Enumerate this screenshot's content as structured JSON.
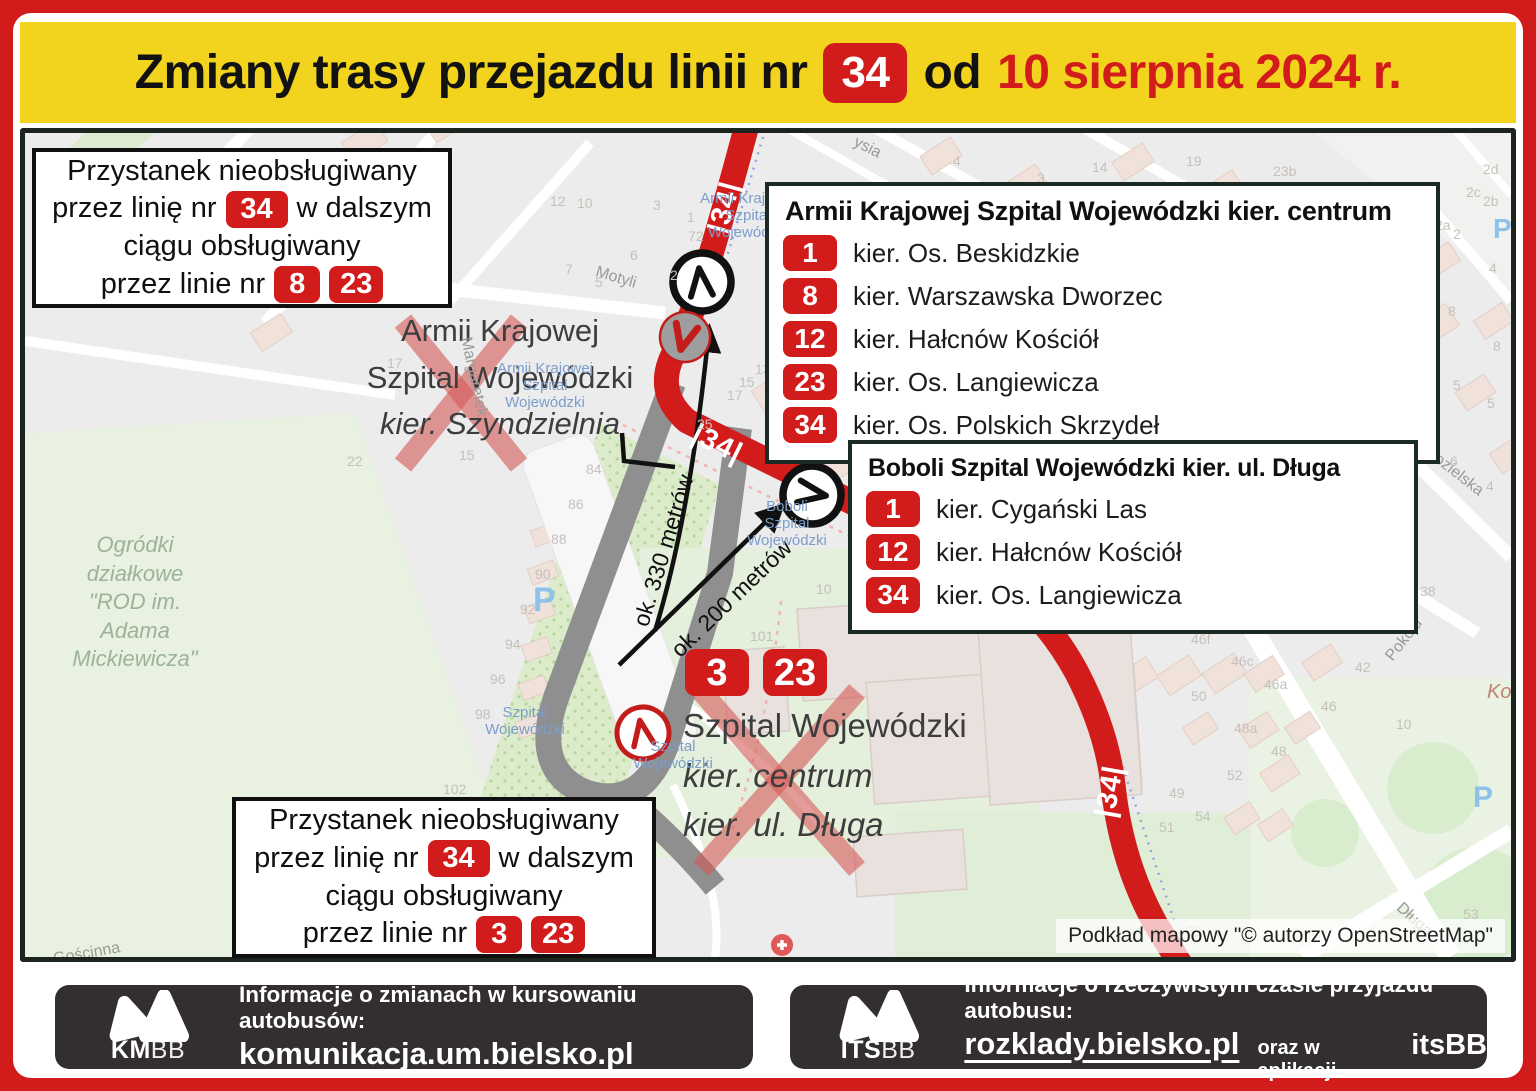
{
  "colors": {
    "accent_red": "#d21b1b",
    "header_yellow": "#f2d31d",
    "footer_dark": "#332e2f",
    "old_route_gray": "#8f8f8f"
  },
  "header": {
    "prefix": "Zmiany trasy przejazdu linii nr",
    "line_badge": "34",
    "mid": "od",
    "date": "10 sierpnia 2024 r."
  },
  "notices": {
    "top": {
      "l1": "Przystanek nieobsługiwany",
      "l2a": "przez linię nr",
      "l2badge": "34",
      "l2b": "w dalszym",
      "l3": "ciągu obsługiwany",
      "l4a": "przez linie nr",
      "badges": [
        "8",
        "23"
      ]
    },
    "bottom": {
      "l1": "Przystanek nieobsługiwany",
      "l2a": "przez linię nr",
      "l2badge": "34",
      "l2b": "w dalszym",
      "l3": "ciągu obsługiwany",
      "l4a": "przez linie nr",
      "badges": [
        "3",
        "23"
      ]
    }
  },
  "stop_boxes": {
    "armii": {
      "title": "Armii Krajowej Szpital Wojewódzki kier. centrum",
      "rows": [
        {
          "line": "1",
          "dest": "kier. Os. Beskidzkie"
        },
        {
          "line": "8",
          "dest": "kier. Warszawska Dworzec"
        },
        {
          "line": "12",
          "dest": "kier. Hałcnów Kościół"
        },
        {
          "line": "23",
          "dest": "kier. Os. Langiewicza"
        },
        {
          "line": "34",
          "dest": "kier. Os. Polskich Skrzydeł"
        }
      ]
    },
    "boboli": {
      "title": "Boboli Szpital Wojewódzki kier. ul. Długa",
      "rows": [
        {
          "line": "1",
          "dest": "kier. Cygański Las"
        },
        {
          "line": "12",
          "dest": "kier. Hałcnów Kościół"
        },
        {
          "line": "34",
          "dest": "kier. Os. Langiewicza"
        }
      ]
    }
  },
  "map": {
    "route_badge": "|34|",
    "attribution": "Podkład mapowy \"© autorzy OpenStreetMap\"",
    "dist330": "ok. 330 metrów",
    "dist200": "ok. 200 metrów",
    "armii_x": {
      "l1": "Armii Krajowej",
      "l2": "Szpital Wojewódzki",
      "l3": "kier. Szyndzielnia"
    },
    "terminal_x": {
      "badges": [
        "3",
        "23"
      ],
      "l1": "Szpital Wojewódzki",
      "l2": "kier. centrum",
      "l3": "kier. ul. Długa"
    },
    "garden_lines": [
      "Ogródki",
      "działkowe",
      "\"ROD im.",
      "Adama",
      "Mickiewicza\""
    ],
    "osm_stops": [
      {
        "x": 723,
        "y": 58,
        "lines": [
          "Armii Krajowej",
          "Szpital",
          "Wojewódzki"
        ]
      },
      {
        "x": 520,
        "y": 228,
        "lines": [
          "Armii Krajowej",
          "Szpital",
          "Wojewódzki"
        ]
      },
      {
        "x": 500,
        "y": 572,
        "lines": [
          "Szpital",
          "Wojewódzki"
        ]
      },
      {
        "x": 648,
        "y": 606,
        "lines": [
          "Szpital",
          "Wojewódzki"
        ]
      },
      {
        "x": 762,
        "y": 366,
        "lines": [
          "Boboli",
          "Szpital",
          "Wojewódzki"
        ]
      }
    ],
    "parking": [
      {
        "x": 508,
        "y": 448,
        "s": 34
      },
      {
        "x": 1448,
        "y": 648,
        "s": 30
      },
      {
        "x": 1468,
        "y": 80,
        "s": 28
      }
    ],
    "streets": [
      {
        "t": "Motyli",
        "x": 570,
        "y": 136,
        "r": 17
      },
      {
        "t": "ysia",
        "x": 828,
        "y": 6,
        "r": 27
      },
      {
        "t": "Margaretek",
        "x": 408,
        "y": 235,
        "r": 78
      },
      {
        "t": "Lniana",
        "x": 1300,
        "y": 450,
        "r": 33
      },
      {
        "t": "Pokoju",
        "x": 1355,
        "y": 498,
        "r": -52
      },
      {
        "t": "Kozielska",
        "x": 1395,
        "y": 330,
        "r": 38
      },
      {
        "t": "Długa",
        "x": 1368,
        "y": 778,
        "r": 42
      },
      {
        "t": "Gościnna",
        "x": 28,
        "y": 812,
        "r": -10
      },
      {
        "t": "Kom",
        "x": 1462,
        "y": 548,
        "r": 0,
        "c": "#c0826d",
        "s": 20,
        "i": true
      }
    ],
    "house_numbers": [
      {
        "t": "12",
        "x": 525,
        "y": 60
      },
      {
        "t": "10",
        "x": 552,
        "y": 62
      },
      {
        "t": "3",
        "x": 628,
        "y": 64
      },
      {
        "t": "1",
        "x": 662,
        "y": 76
      },
      {
        "t": "72",
        "x": 663,
        "y": 95
      },
      {
        "t": "6",
        "x": 605,
        "y": 114
      },
      {
        "t": "7",
        "x": 540,
        "y": 128
      },
      {
        "t": "5",
        "x": 570,
        "y": 141
      },
      {
        "t": "2",
        "x": 645,
        "y": 134
      },
      {
        "t": "4",
        "x": 928,
        "y": 20
      },
      {
        "t": "3",
        "x": 1012,
        "y": 37
      },
      {
        "t": "14",
        "x": 1067,
        "y": 26
      },
      {
        "t": "19",
        "x": 1161,
        "y": 20
      },
      {
        "t": "23b",
        "x": 1248,
        "y": 30
      },
      {
        "t": "2d",
        "x": 1458,
        "y": 28
      },
      {
        "t": "2c",
        "x": 1441,
        "y": 51
      },
      {
        "t": "2b",
        "x": 1458,
        "y": 60
      },
      {
        "t": "2a",
        "x": 1410,
        "y": 84
      },
      {
        "t": "2",
        "x": 1428,
        "y": 93
      },
      {
        "t": "4",
        "x": 1464,
        "y": 127
      },
      {
        "t": "8",
        "x": 1423,
        "y": 170
      },
      {
        "t": "8",
        "x": 1468,
        "y": 205
      },
      {
        "t": "5",
        "x": 1428,
        "y": 244
      },
      {
        "t": "5",
        "x": 1462,
        "y": 262
      },
      {
        "t": "6",
        "x": 1425,
        "y": 320
      },
      {
        "t": "4",
        "x": 1461,
        "y": 345
      },
      {
        "t": "17",
        "x": 362,
        "y": 222
      },
      {
        "t": "22",
        "x": 322,
        "y": 320
      },
      {
        "t": "15",
        "x": 434,
        "y": 314
      },
      {
        "t": "13",
        "x": 730,
        "y": 228
      },
      {
        "t": "15",
        "x": 714,
        "y": 241
      },
      {
        "t": "17",
        "x": 702,
        "y": 254
      },
      {
        "t": "25",
        "x": 672,
        "y": 283
      },
      {
        "t": "18b",
        "x": 794,
        "y": 271
      },
      {
        "t": "18c",
        "x": 788,
        "y": 289
      },
      {
        "t": "18d",
        "x": 778,
        "y": 303
      },
      {
        "t": "19",
        "x": 832,
        "y": 293
      },
      {
        "t": "17",
        "x": 894,
        "y": 275
      },
      {
        "t": "33a",
        "x": 930,
        "y": 318
      },
      {
        "t": "84",
        "x": 561,
        "y": 328
      },
      {
        "t": "86",
        "x": 543,
        "y": 363
      },
      {
        "t": "88",
        "x": 526,
        "y": 398
      },
      {
        "t": "90",
        "x": 510,
        "y": 433
      },
      {
        "t": "92",
        "x": 495,
        "y": 468
      },
      {
        "t": "94",
        "x": 480,
        "y": 503
      },
      {
        "t": "96",
        "x": 465,
        "y": 538
      },
      {
        "t": "98",
        "x": 450,
        "y": 573
      },
      {
        "t": "102",
        "x": 418,
        "y": 648
      },
      {
        "t": "104",
        "x": 406,
        "y": 686
      },
      {
        "t": "101",
        "x": 725,
        "y": 495
      },
      {
        "t": "10",
        "x": 791,
        "y": 448
      },
      {
        "t": "46h",
        "x": 1133,
        "y": 478
      },
      {
        "t": "46f",
        "x": 1166,
        "y": 498
      },
      {
        "t": "46c",
        "x": 1206,
        "y": 520
      },
      {
        "t": "46a",
        "x": 1239,
        "y": 543
      },
      {
        "t": "50",
        "x": 1166,
        "y": 555
      },
      {
        "t": "42",
        "x": 1330,
        "y": 526
      },
      {
        "t": "46",
        "x": 1296,
        "y": 565
      },
      {
        "t": "48a",
        "x": 1209,
        "y": 587
      },
      {
        "t": "48",
        "x": 1246,
        "y": 610
      },
      {
        "t": "52",
        "x": 1202,
        "y": 634
      },
      {
        "t": "49",
        "x": 1144,
        "y": 652
      },
      {
        "t": "54",
        "x": 1170,
        "y": 675
      },
      {
        "t": "51",
        "x": 1134,
        "y": 686
      },
      {
        "t": "38",
        "x": 1395,
        "y": 450
      },
      {
        "t": "10",
        "x": 1371,
        "y": 583
      },
      {
        "t": "39",
        "x": 1161,
        "y": 790
      },
      {
        "t": "53",
        "x": 1438,
        "y": 773
      }
    ]
  },
  "footer": {
    "left": {
      "logo_bold": "KM",
      "logo_light": "BB",
      "line1": "Informacje o zmianach w kursowaniu autobusów:",
      "link": "komunikacja.um.bielsko.pl"
    },
    "right": {
      "logo_bold": "ITS",
      "logo_light": "BB",
      "line1": "Informacje o rzeczywistym czasie przyjazdu autobusu:",
      "link": "rozklady.bielsko.pl",
      "mid": "oraz w aplikacji",
      "app": "itsBB"
    }
  }
}
